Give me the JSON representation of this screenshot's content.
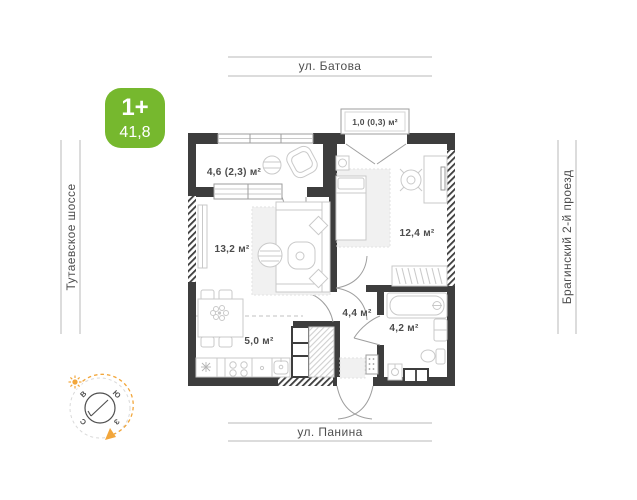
{
  "map_labels": {
    "street_top": "ул. Батова",
    "street_bottom": "ул. Панина",
    "street_left": "Тутаевское шоссе",
    "street_right": "Брагинский 2-й проезд"
  },
  "badge": {
    "rooms": "1+",
    "area": "41,8",
    "color": "#76b82e"
  },
  "plan": {
    "rooms": {
      "loggia": "4,6 (2,3) м²",
      "balcony": "1,0 (0,3) м²",
      "living": "13,2 м²",
      "bedroom": "12,4 м²",
      "kitchen": "5,0 м²",
      "hallway": "4,4 м²",
      "bathroom": "4,2 м²"
    }
  },
  "compass": {
    "north": "С",
    "south": "Ю",
    "east": "В",
    "west": "З"
  },
  "colors": {
    "wall": "#3d3d3d",
    "furniture_line": "#c9c9c9",
    "room_text": "#4c4c4c",
    "street_line": "#b8b8b8",
    "street_text": "#4f4f4f",
    "accent_orange": "#f2a63b",
    "badge_green": "#76b82e"
  }
}
